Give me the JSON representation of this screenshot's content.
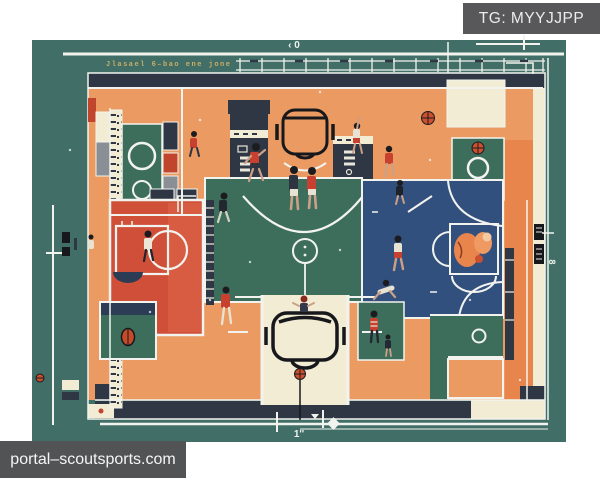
{
  "watermarks": {
    "tag": "TG: MYYJJPP",
    "site": "portal–scoutsports.com"
  },
  "annotations": {
    "top_marker": "‹ 0",
    "blueprint_note": "Jlasael 6–bao ene jone",
    "bottom_measure": "1''",
    "right_measure": "8"
  },
  "palette": {
    "canvas_teal": "#416e66",
    "court_orange": "#eb9a62",
    "court_orange_deep": "#e8854d",
    "court_red": "#cf4f38",
    "court_navy": "#32507e",
    "court_green": "#3d6e5c",
    "cream": "#f3ecd4",
    "slate": "#2f3744",
    "line_white": "#f2f3ee",
    "watermark_gray": "#58585a",
    "ball_orange": "#cc4f2e",
    "note_tan": "#c9ae67"
  }
}
